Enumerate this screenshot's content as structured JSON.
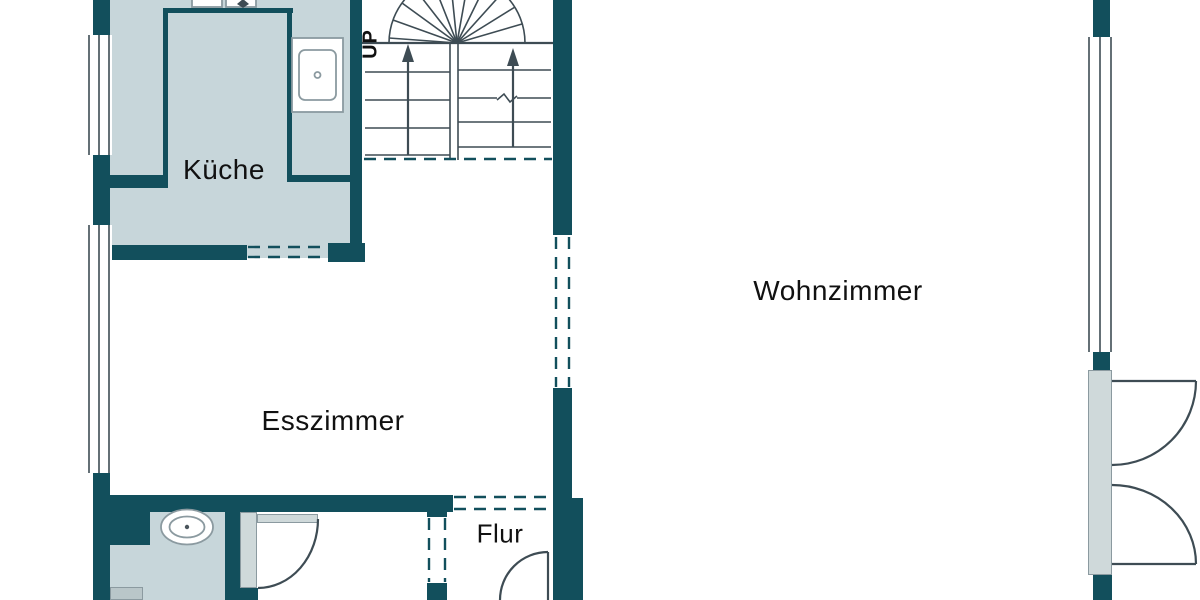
{
  "plan": {
    "type": "floor-plan",
    "rooms": [
      {
        "id": "kueche",
        "label": "Küche"
      },
      {
        "id": "esszimmer",
        "label": "Esszimmer"
      },
      {
        "id": "wohnzimmer",
        "label": "Wohnzimmer"
      },
      {
        "id": "flur",
        "label": "Flur"
      }
    ],
    "stairs": {
      "direction_label": "UP",
      "style": "u-shaped winder stair with fan treads"
    },
    "fixtures": [
      {
        "name": "kitchen-sink"
      },
      {
        "name": "kitchen-counter"
      },
      {
        "name": "cooktop"
      },
      {
        "name": "bathroom-sink"
      },
      {
        "name": "single-door-bathroom"
      },
      {
        "name": "double-french-door"
      },
      {
        "name": "entry-door"
      },
      {
        "name": "window-left-upper"
      },
      {
        "name": "window-left-lower"
      },
      {
        "name": "window-right"
      }
    ],
    "colors": {
      "wall": "#124f5c",
      "floor_light": "#c7d6da",
      "door_panel": "#cfd9da",
      "fixture_outline": "#8b9aa0",
      "line": "#3e4c54",
      "text": "#111111",
      "background": "#ffffff"
    }
  }
}
